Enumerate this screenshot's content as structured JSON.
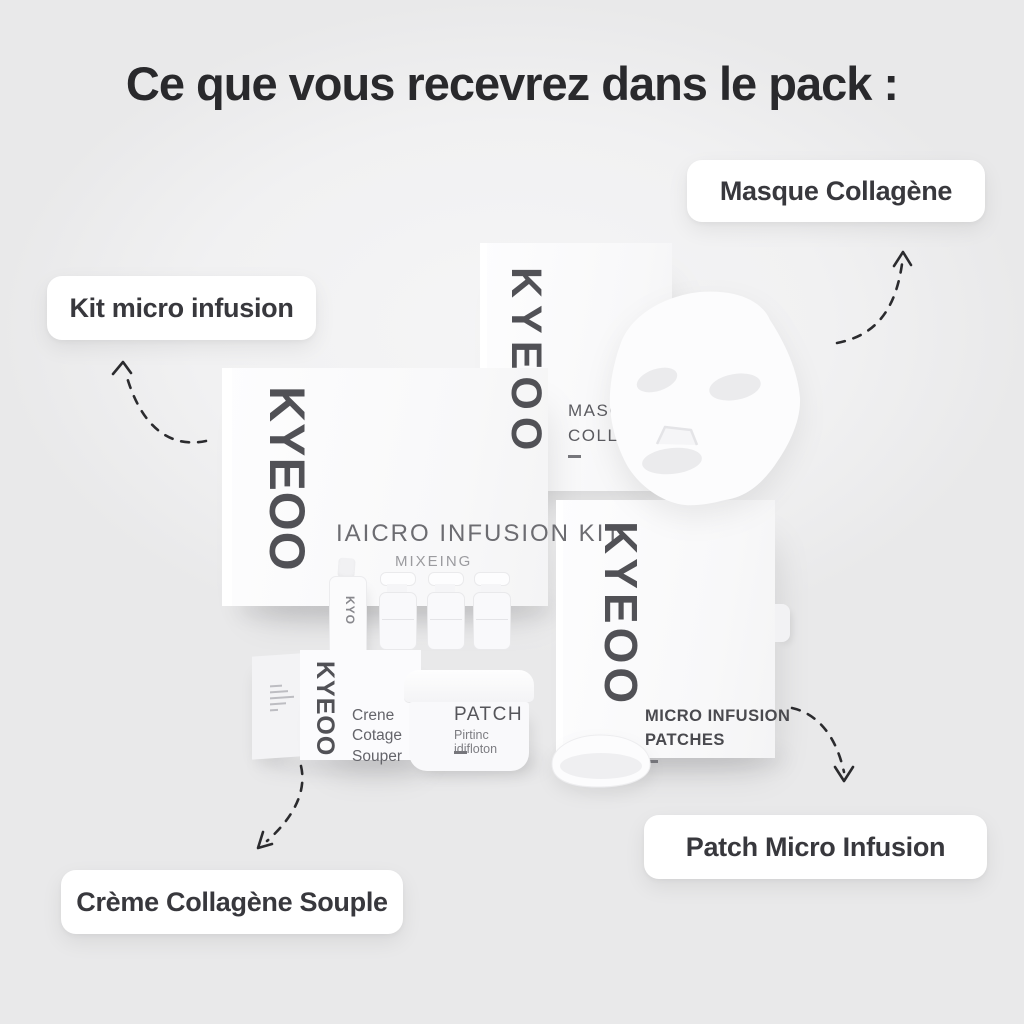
{
  "title": "Ce que vous recevrez dans le pack :",
  "brand": "KYEOO",
  "callouts": {
    "masque": "Masque Collagène",
    "kit": "Kit micro infusion",
    "creme": "Crème Collagène Souple",
    "patch": "Patch Micro Infusion"
  },
  "products": {
    "mask_box": {
      "line1": "MASOU",
      "line2": "COLLAI"
    },
    "kit_box": {
      "title": "IAICRO INFUSION KIT",
      "subtitle": "MIXEING"
    },
    "dropper": {
      "brand": "KYO"
    },
    "creme_box": {
      "line1": "Crene",
      "line2": "Cotage",
      "line3": "Souper"
    },
    "jar": {
      "title": "PATCH",
      "subtitle": "Pirtinc idifloton"
    },
    "patches_box": {
      "line1": "MICRO INFUSION",
      "line2": "PATCHES"
    }
  },
  "colors": {
    "background": "#f1f1f2",
    "ink": "#29292c",
    "label_text": "#38383d",
    "logo": "#515156",
    "arrow": "#2b2b2e",
    "box_face": "#fbfbfc"
  }
}
